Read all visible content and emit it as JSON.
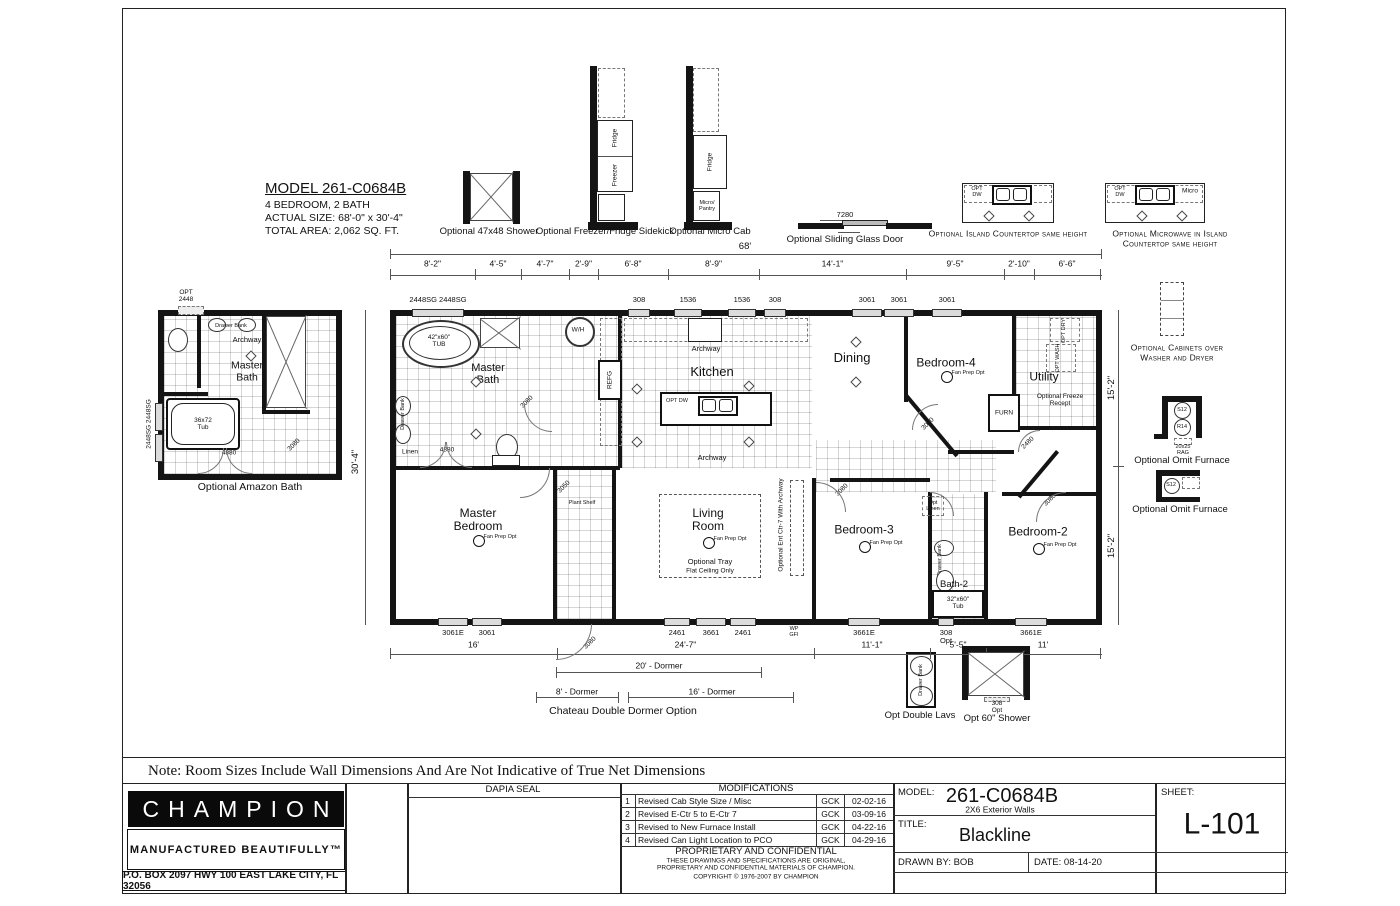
{
  "sheet_note": "Note: Room Sizes Include Wall Dimensions And Are Not Indicative of True Net Dimensions",
  "model_info": {
    "title": "MODEL 261-C0684B",
    "beds": "4 BEDROOM, 2 BATH",
    "size": "ACTUAL SIZE: 68'-0\" x 30'-4\"",
    "area": "TOTAL AREA: 2,062 SQ. FT."
  },
  "top_options": {
    "shower_label": "Optional 47x48 Shower",
    "shower_inner": "47x48 Shower",
    "sidekick_label": "Optional Freezer/Fridge Sidekick",
    "sidekick_fridge": "Fridge",
    "sidekick_freezer": "Freezer",
    "microcab_label": "Optional Micro Cab",
    "microcab_fridge": "Fridge",
    "microcab_micro": "Micro/ Pantry",
    "sliding_label": "Optional Sliding Glass Door",
    "sliding_dim": "7280",
    "island_label": "Optional Island Countertop same height",
    "micro_island_label1": "Optional Microwave in Island",
    "micro_island_label2": "Countertop same height",
    "opt_dw": "OPT DW",
    "micro": "Micro"
  },
  "plan": {
    "overall_dim": "68'",
    "top_dims": [
      "8'-2\"",
      "4'-5\"",
      "4'-7\"",
      "2'-9\"",
      "6'-8\"",
      "8'-9\"",
      "14'-1\"",
      "9'-5\"",
      "2'-10\"",
      "6'-6\""
    ],
    "bottom_dims": [
      "16'",
      "24'-7\"",
      "11'-1\"",
      "5'-5\"",
      "11'"
    ],
    "left_dim": "30'-4\"",
    "right_dim_top": "15'-2\"",
    "right_dim_bottom": "15'-2\"",
    "top_windows": [
      "2448SG 2448SG",
      "308",
      "1536",
      "1536",
      "308",
      "3061",
      "3061",
      "3061"
    ],
    "bottom_windows": [
      "3061E",
      "3061",
      "2461",
      "3661",
      "2461",
      "3661E",
      "308 Opt",
      "3661E"
    ],
    "rooms": {
      "master_bath": "Master Bath",
      "kitchen": "Kitchen",
      "dining": "Dining",
      "bedroom4": "Bedroom-4",
      "utility": "Utility",
      "master_bedroom": "Master Bedroom",
      "living": "Living Room",
      "bedroom3": "Bedroom-3",
      "bedroom2": "Bedroom-2",
      "bath2": "Bath-2"
    },
    "fan_label": "Fan Prep Opt",
    "labels": {
      "tub": "42\"x60\" TUB",
      "shwr": "SHWR",
      "wh": "W/H",
      "refg": "REFG",
      "archway": "Archway",
      "linen": "Linen",
      "plant_shelf": "Plant Shelf",
      "opt_tray1": "Optional Tray",
      "opt_tray2": "Flat Ceiling Only",
      "ent_ctr": "Optional Ent Ctr-7 With Archway",
      "opt_linen": "Opt Linen",
      "drawer_bank": "Drawer Bank",
      "tub2": "32\"x60\" Tub",
      "furn": "FURN",
      "freeze_recept": "Optional Freeze Recept",
      "opt_dry": "OPT DRY",
      "opt_wash": "OPT WASH",
      "wp_gfi": "WP GFI"
    },
    "door_labels": {
      "d4880": "4880",
      "d3080": "3080",
      "d3050": "3050",
      "d2480": "2480"
    }
  },
  "amazon": {
    "label": "Optional Amazon Bath",
    "opt_2448": "OPT 2448",
    "master_bath": "Master Bath",
    "archway": "Archway",
    "shower": "4896 Shower w/ Seat",
    "tub": "36x72 Tub",
    "windows": "2448SG 2448SG",
    "d4880": "4880",
    "d3080": "3080",
    "drawer_bank": "Drawer Bank"
  },
  "right_options": {
    "cabinets1": "Optional Cabinets over",
    "cabinets2": "Washer and Dryer",
    "omit_furnace": "Optional Omit Furnace",
    "s12": "S12",
    "r14": "R14",
    "rag": "20x25 RAG"
  },
  "bottom_options": {
    "dormer20": "20' - Dormer",
    "dormer8": "8' - Dormer",
    "dormer16": "16' - Dormer",
    "chateau": "Chateau Double Dormer Option",
    "lavs": "Opt Double Lavs",
    "shower60": "Opt 60\" Shower",
    "shower3660": "3660 Shower",
    "win308": "308 Opt",
    "drawer_bank": "Drawer Bank"
  },
  "titleblock": {
    "brand": "CHAMPION",
    "tagline": "MANUFACTURED BEAUTIFULLY™",
    "address": "P.O. BOX 2097 HWY 100 EAST LAKE CITY, FL  32056",
    "dapia": "DAPIA SEAL",
    "mods_header": "MODIFICATIONS",
    "mods": [
      [
        "1",
        "Revised Cab Style Size / Misc",
        "GCK",
        "02-02-16"
      ],
      [
        "2",
        "Revised E-Ctr 5 to E-Ctr 7",
        "GCK",
        "03-09-16"
      ],
      [
        "3",
        "Revised to New Furnace Install",
        "GCK",
        "04-22-16"
      ],
      [
        "4",
        "Revised Can Light Location to PCO",
        "GCK",
        "04-29-16"
      ]
    ],
    "prop_title": "PROPRIETARY AND CONFIDENTIAL",
    "prop_line1": "THESE DRAWINGS AND SPECIFICATIONS ARE ORIGINAL,",
    "prop_line2": "PROPRIETARY AND CONFIDENTIAL MATERIALS OF CHAMPION.",
    "prop_line3": "COPYRIGHT © 1976-2007 BY CHAMPION",
    "model_label": "MODEL:",
    "model_value": "261-C0684B",
    "model_sub": "2X6 Exterior Walls",
    "title_label": "TITLE:",
    "title_value": "Blackline",
    "drawn_by": "DRAWN BY: BOB",
    "date": "DATE: 08-14-20",
    "sheet_label": "SHEET:",
    "sheet_value": "L-101"
  }
}
